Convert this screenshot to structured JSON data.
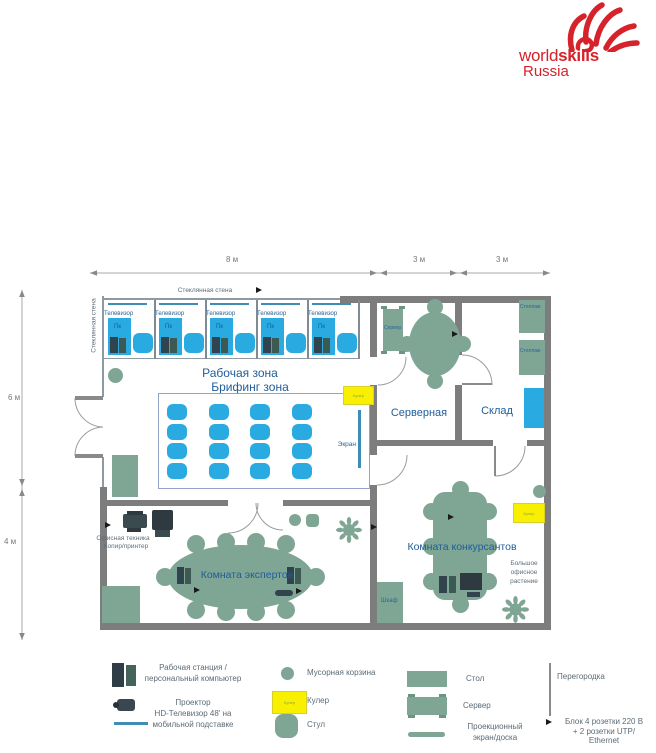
{
  "logo": {
    "brand_light": "world",
    "brand_bold": "skills",
    "region": "Russia"
  },
  "dimensions": {
    "top_main": "8 м",
    "top_mid": "3 м",
    "top_right": "3 м",
    "left_upper": "6 м",
    "left_lower": "4 м"
  },
  "plan": {
    "glass_wall_top": "Стеклянная стена",
    "glass_wall_left": "Стеклянная стена",
    "work_zone": "Рабочая зона",
    "briefing_zone": "Брифинг зона",
    "server_room": "Серверная",
    "storage_room": "Склад",
    "experts_room": "Комната экспертов",
    "competitors_room": "Комната конкурсантов",
    "tv": "Телевизор",
    "pc": "Пк",
    "screen": "Экран",
    "server": "Сервер",
    "shelf": "Стеллаж",
    "cooler": "Кулер",
    "cabinet": "Шкаф",
    "office_equipment_line1": "Офисная техника",
    "office_equipment_line2": "Копир/принтер",
    "plant_line1": "Большое",
    "plant_line2": "офисное",
    "plant_line3": "растение",
    "workstation_count": 5,
    "briefing_rows": 4,
    "briefing_cols": 4
  },
  "legend": {
    "workstation_line1": "Рабочая станция /",
    "workstation_line2": "персональный компьютер",
    "projector": "Проектор",
    "tv_line1": "HD-Телевизор 48' на",
    "tv_line2": "мобильной подставке",
    "trash": "Мусорная корзина",
    "cooler": "Кулер",
    "chair": "Стул",
    "table": "Стол",
    "server": "Сервер",
    "screen_line1": "Проекционный",
    "screen_line2": "экран/доска",
    "partition": "Перегородка",
    "socket_line1": "Блок 4 розетки 220 В",
    "socket_line2": "+ 2 розетки UTP/",
    "socket_line3": "Ethernet"
  },
  "colors": {
    "chair_blue": "#29ABE2",
    "furniture_green": "#7FA694",
    "tv_teal": "#3F8CB4",
    "cooler_yellow": "#F8F000",
    "wall_gray": "#7D7D7D",
    "brand_red": "#D6222A",
    "label_blue": "#1F5C99"
  }
}
